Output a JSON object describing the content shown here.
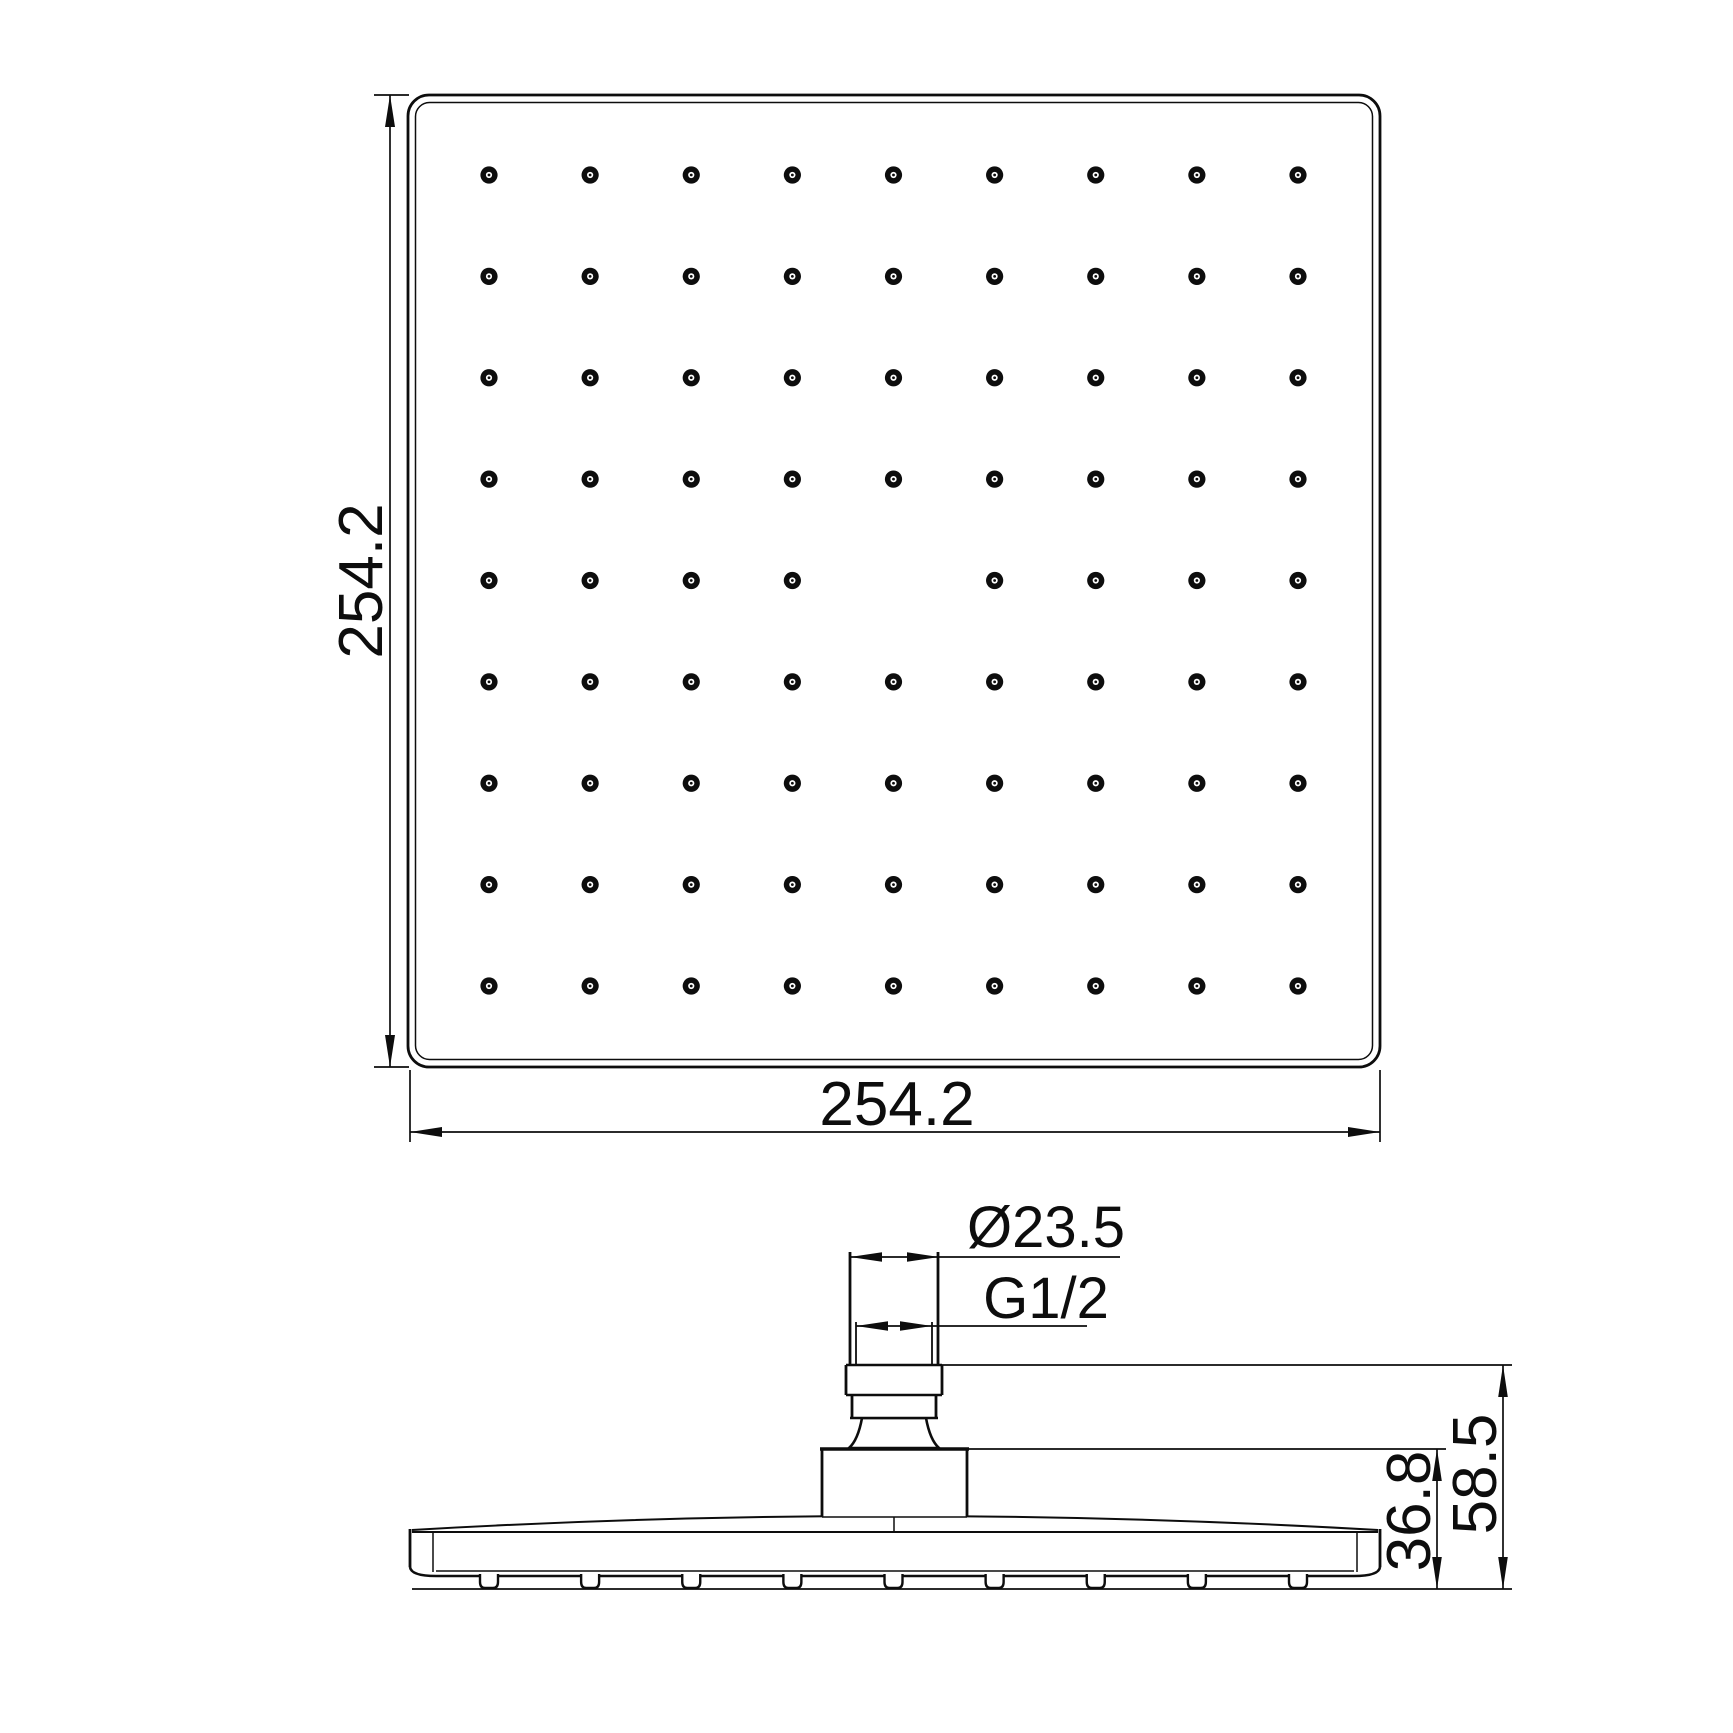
{
  "drawing": {
    "background_color": "#ffffff",
    "line_color": "#0d0d0d",
    "top_view": {
      "width_label": "254.2",
      "height_label": "254.2",
      "nozzle_rows": 9,
      "nozzle_cols": 9,
      "missing_nozzles": [
        [
          4,
          4
        ]
      ],
      "nozzle_count": 80
    },
    "side_view": {
      "connector_diameter_label": "Ø23.5",
      "thread_label": "G1/2",
      "overall_height_label": "58.5",
      "head_height_label": "36.8"
    }
  }
}
